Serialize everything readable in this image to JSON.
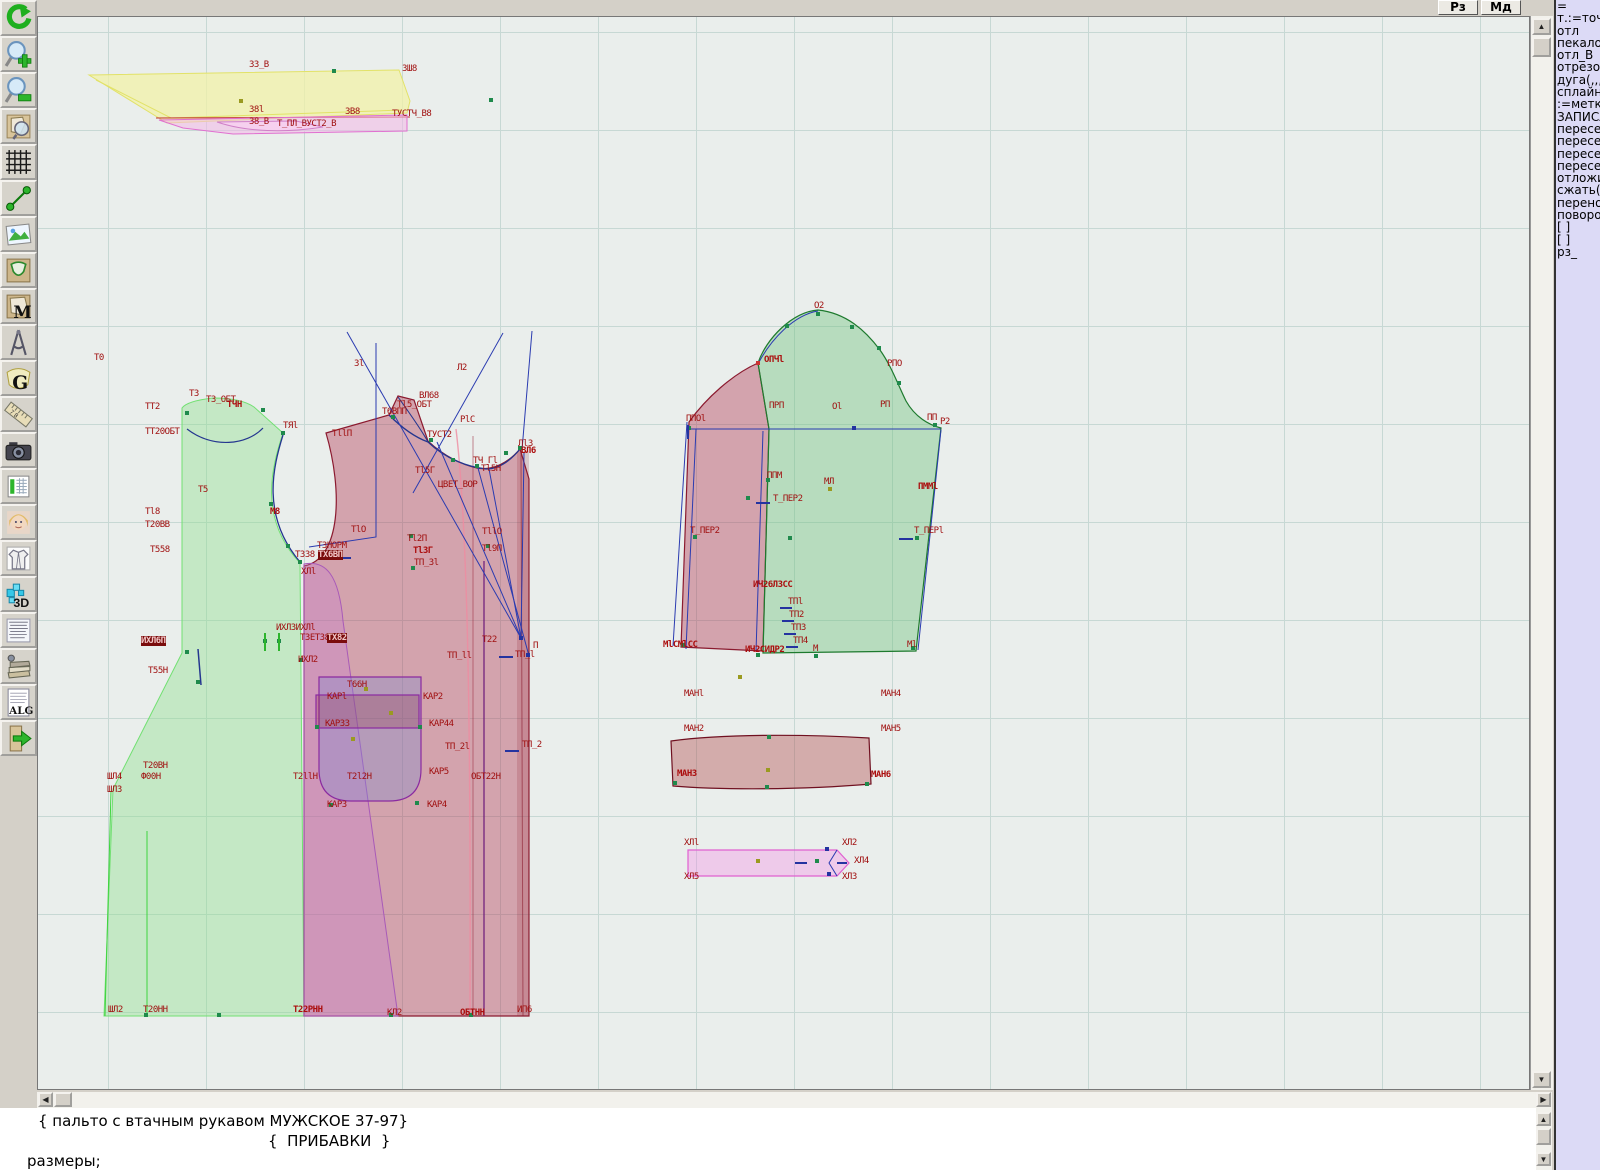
{
  "window": {
    "rz_button": "Рз",
    "md_button": "Мд"
  },
  "toolbar": {
    "items": [
      {
        "name": "undo",
        "glyph": ""
      },
      {
        "name": "zoom-in",
        "glyph": ""
      },
      {
        "name": "zoom-out",
        "glyph": ""
      },
      {
        "name": "preview",
        "glyph": ""
      },
      {
        "name": "grid",
        "glyph": ""
      },
      {
        "name": "line-tool",
        "glyph": ""
      },
      {
        "name": "image",
        "glyph": ""
      },
      {
        "name": "pattern",
        "glyph": ""
      },
      {
        "name": "pattern-m",
        "glyph": "M"
      },
      {
        "name": "compass",
        "glyph": ""
      },
      {
        "name": "g-tool",
        "glyph": "G"
      },
      {
        "name": "ruler",
        "glyph": "7 8"
      },
      {
        "name": "camera",
        "glyph": ""
      },
      {
        "name": "table",
        "glyph": ""
      },
      {
        "name": "portrait",
        "glyph": ""
      },
      {
        "name": "garment",
        "glyph": ""
      },
      {
        "name": "three-d",
        "glyph": "3D"
      },
      {
        "name": "text-list",
        "glyph": ""
      },
      {
        "name": "books",
        "glyph": ""
      },
      {
        "name": "alg",
        "glyph": "ALG"
      },
      {
        "name": "exit",
        "glyph": ""
      }
    ]
  },
  "right_panel": {
    "lines": [
      "=",
      "т.:=точка",
      "отл",
      "пекало",
      "отл_В",
      "отрезок",
      "дуга(,,,)",
      "сплайн_",
      ":=метка",
      "ЗАПИСА",
      "пересеч",
      "пересеч",
      "пересеч",
      "пересеч",
      "отложит",
      "сжать(()",
      "перенос",
      "поворот",
      "[ ]",
      "[ ]",
      "рз_"
    ]
  },
  "bottom_panel": {
    "lines": [
      "{ пальто с втачным рукавом МУЖСКОЕ 37-97}",
      "{  ПРИБАВКИ  }",
      "размеры;"
    ]
  },
  "colors": {
    "canvas_bg": "#eaeeec",
    "grid_line": "#c7d8d4",
    "label_red": "#a01010",
    "back_piece_green": "#8ee08e",
    "front_piece_maroon": "#b23350",
    "facing_violet": "#c77fd0",
    "sleeve_green": "#6fc47f",
    "pink_band": "#f688e8",
    "collar_yellow": "#f2f2a8",
    "construction_blue": "#2a3bb0",
    "panel_bg": "#dcdaf6"
  },
  "canvas": {
    "labels": [
      {
        "t": "З3_В",
        "x": 248,
        "y": 63
      },
      {
        "t": "ЗШ8",
        "x": 401,
        "y": 67
      },
      {
        "t": "З8l",
        "x": 248,
        "y": 108
      },
      {
        "t": "ЗВ8",
        "x": 344,
        "y": 110
      },
      {
        "t": "ТУСТЧ_В8",
        "x": 391,
        "y": 112
      },
      {
        "t": "З8_В",
        "x": 248,
        "y": 120
      },
      {
        "t": "Т_ПЛ_ВУСТ2_В",
        "x": 276,
        "y": 122
      },
      {
        "t": "Т0",
        "x": 93,
        "y": 356
      },
      {
        "t": "Т3",
        "x": 188,
        "y": 392
      },
      {
        "t": "Т3_ОБТ",
        "x": 205,
        "y": 398
      },
      {
        "t": "ТТ2",
        "x": 144,
        "y": 405
      },
      {
        "t": "ТЧН",
        "x": 226,
        "y": 403,
        "b": 1
      },
      {
        "t": "ТТ20ОБТ",
        "x": 144,
        "y": 430
      },
      {
        "t": "ТЯl",
        "x": 282,
        "y": 424
      },
      {
        "t": "Т5",
        "x": 197,
        "y": 488
      },
      {
        "t": "Тl8",
        "x": 144,
        "y": 510
      },
      {
        "t": "М8",
        "x": 269,
        "y": 510,
        "b": 1
      },
      {
        "t": "Т20ВВ",
        "x": 144,
        "y": 523
      },
      {
        "t": "Т558",
        "x": 149,
        "y": 548
      },
      {
        "t": "ТЗНОРМ",
        "x": 316,
        "y": 544
      },
      {
        "t": "Т338",
        "x": 294,
        "y": 553
      },
      {
        "t": "ТХ6ВП",
        "x": 317,
        "y": 553,
        "hl": 1
      },
      {
        "t": "ХЛl",
        "x": 300,
        "y": 570
      },
      {
        "t": "ИХЛЗИХЛl",
        "x": 275,
        "y": 626
      },
      {
        "t": "Т3ЕТ38",
        "x": 299,
        "y": 636
      },
      {
        "t": "ТХ82",
        "x": 326,
        "y": 636,
        "hl": 1
      },
      {
        "t": "ИХЛ6П",
        "x": 140,
        "y": 639,
        "hl": 1
      },
      {
        "t": "ИХЛ2",
        "x": 297,
        "y": 658
      },
      {
        "t": "Т55Н",
        "x": 147,
        "y": 669
      },
      {
        "t": "Т20ВН",
        "x": 142,
        "y": 764
      },
      {
        "t": "ШЛ4",
        "x": 106,
        "y": 775
      },
      {
        "t": "Ф00Н",
        "x": 140,
        "y": 775
      },
      {
        "t": "ШЛ3",
        "x": 106,
        "y": 788
      },
      {
        "t": "ШЛ2",
        "x": 107,
        "y": 1008
      },
      {
        "t": "Т20НН",
        "x": 142,
        "y": 1008
      },
      {
        "t": "Т22РНН",
        "x": 292,
        "y": 1008,
        "b": 1
      },
      {
        "t": "КЛ2",
        "x": 386,
        "y": 1011
      },
      {
        "t": "ОБТНН",
        "x": 459,
        "y": 1011,
        "b": 1
      },
      {
        "t": "ИП6",
        "x": 516,
        "y": 1008
      },
      {
        "t": "Зl",
        "x": 353,
        "y": 362
      },
      {
        "t": "Л2",
        "x": 456,
        "y": 366
      },
      {
        "t": "ВЛ68",
        "x": 418,
        "y": 394
      },
      {
        "t": "Тl5_ОБТ",
        "x": 396,
        "y": 403
      },
      {
        "t": "Т6ВПП",
        "x": 381,
        "y": 410
      },
      {
        "t": "РlС",
        "x": 459,
        "y": 418
      },
      {
        "t": "ТllП",
        "x": 331,
        "y": 432
      },
      {
        "t": "ТУСТ2",
        "x": 426,
        "y": 433
      },
      {
        "t": "Лl3",
        "x": 517,
        "y": 442
      },
      {
        "t": "ВЛ6",
        "x": 520,
        "y": 449,
        "b": 1
      },
      {
        "t": "ТЧ_Гl",
        "x": 472,
        "y": 459
      },
      {
        "t": "Тl5Н",
        "x": 480,
        "y": 467
      },
      {
        "t": "Тl5Г",
        "x": 414,
        "y": 469
      },
      {
        "t": "ЦВЕТ_ВОР",
        "x": 437,
        "y": 483
      },
      {
        "t": "ТlО",
        "x": 350,
        "y": 528
      },
      {
        "t": "Тl2П",
        "x": 406,
        "y": 537
      },
      {
        "t": "ТllО",
        "x": 481,
        "y": 530
      },
      {
        "t": "ТlЗГ",
        "x": 412,
        "y": 549,
        "b": 1
      },
      {
        "t": "Тl9П",
        "x": 481,
        "y": 547
      },
      {
        "t": "ТП_Зl",
        "x": 413,
        "y": 561
      },
      {
        "t": "Т22",
        "x": 481,
        "y": 638
      },
      {
        "t": "ТП_ll",
        "x": 446,
        "y": 654
      },
      {
        "t": "ТП_l",
        "x": 514,
        "y": 653
      },
      {
        "t": "П",
        "x": 532,
        "y": 644
      },
      {
        "t": "Т66Н",
        "x": 346,
        "y": 683
      },
      {
        "t": "КАРl",
        "x": 326,
        "y": 695
      },
      {
        "t": "КАР2",
        "x": 422,
        "y": 695
      },
      {
        "t": "КАР33",
        "x": 324,
        "y": 722
      },
      {
        "t": "КАР44",
        "x": 428,
        "y": 722
      },
      {
        "t": "ТП_2l",
        "x": 444,
        "y": 745
      },
      {
        "t": "ТП_2",
        "x": 521,
        "y": 743
      },
      {
        "t": "Т2llН",
        "x": 292,
        "y": 775
      },
      {
        "t": "Т2l2Н",
        "x": 346,
        "y": 775
      },
      {
        "t": "КАР5",
        "x": 428,
        "y": 770
      },
      {
        "t": "ОБТ22Н",
        "x": 470,
        "y": 775
      },
      {
        "t": "КАР3",
        "x": 326,
        "y": 803
      },
      {
        "t": "КАР4",
        "x": 426,
        "y": 803
      },
      {
        "t": "О2",
        "x": 813,
        "y": 304
      },
      {
        "t": "ОПЧl",
        "x": 763,
        "y": 358,
        "b": 1
      },
      {
        "t": "РПО",
        "x": 886,
        "y": 362
      },
      {
        "t": "ПРП",
        "x": 768,
        "y": 404
      },
      {
        "t": "Оl",
        "x": 831,
        "y": 405
      },
      {
        "t": "РП",
        "x": 879,
        "y": 403
      },
      {
        "t": "ПП",
        "x": 926,
        "y": 416
      },
      {
        "t": "Р2",
        "x": 939,
        "y": 420
      },
      {
        "t": "ППОl",
        "x": 685,
        "y": 417
      },
      {
        "t": "ППМ",
        "x": 766,
        "y": 474
      },
      {
        "t": "МЛ",
        "x": 823,
        "y": 480
      },
      {
        "t": "ПММl",
        "x": 917,
        "y": 485,
        "b": 1
      },
      {
        "t": "Т_ПЕР2",
        "x": 772,
        "y": 497
      },
      {
        "t": "Т_ПЕР2",
        "x": 689,
        "y": 529
      },
      {
        "t": "Т_ПЕРl",
        "x": 913,
        "y": 529
      },
      {
        "t": "ИЧ26ЛЗСС",
        "x": 752,
        "y": 583,
        "b": 1
      },
      {
        "t": "ТПl",
        "x": 787,
        "y": 600
      },
      {
        "t": "ТП2",
        "x": 788,
        "y": 613
      },
      {
        "t": "ТП3",
        "x": 790,
        "y": 626
      },
      {
        "t": "ТП4",
        "x": 792,
        "y": 639
      },
      {
        "t": "МlСМlСС",
        "x": 662,
        "y": 643,
        "b": 1
      },
      {
        "t": "ИЧ2СИДР2",
        "x": 744,
        "y": 648,
        "b": 1
      },
      {
        "t": "М",
        "x": 812,
        "y": 647
      },
      {
        "t": "Мl",
        "x": 906,
        "y": 643
      },
      {
        "t": "МАНl",
        "x": 683,
        "y": 692
      },
      {
        "t": "МАН4",
        "x": 880,
        "y": 692
      },
      {
        "t": "МАН2",
        "x": 683,
        "y": 727
      },
      {
        "t": "МАН5",
        "x": 880,
        "y": 727
      },
      {
        "t": "МАН3",
        "x": 676,
        "y": 772,
        "b": 1
      },
      {
        "t": "МАН6",
        "x": 870,
        "y": 773,
        "b": 1
      },
      {
        "t": "ХЛl",
        "x": 683,
        "y": 841
      },
      {
        "t": "ХЛ2",
        "x": 841,
        "y": 841
      },
      {
        "t": "ХЛ4",
        "x": 853,
        "y": 859
      },
      {
        "t": "ХЛ5",
        "x": 683,
        "y": 875
      },
      {
        "t": "ХЛ3",
        "x": 841,
        "y": 875
      }
    ],
    "points": [
      [
        333,
        70,
        "g"
      ],
      [
        240,
        100,
        "o"
      ],
      [
        490,
        99,
        "g"
      ],
      [
        186,
        412,
        "g"
      ],
      [
        262,
        409,
        "g"
      ],
      [
        282,
        432,
        "g"
      ],
      [
        270,
        503,
        "g"
      ],
      [
        287,
        545,
        "g"
      ],
      [
        299,
        561,
        "g"
      ],
      [
        186,
        651,
        "g"
      ],
      [
        197,
        681,
        "g"
      ],
      [
        264,
        640,
        "g"
      ],
      [
        278,
        640,
        "g"
      ],
      [
        218,
        1014,
        "g"
      ],
      [
        145,
        1014,
        "g"
      ],
      [
        392,
        416,
        "g"
      ],
      [
        430,
        439,
        "g"
      ],
      [
        452,
        459,
        "g"
      ],
      [
        476,
        465,
        "g"
      ],
      [
        505,
        452,
        "g"
      ],
      [
        519,
        447,
        "g"
      ],
      [
        410,
        535,
        "g"
      ],
      [
        487,
        545,
        "g"
      ],
      [
        412,
        567,
        "g"
      ],
      [
        520,
        637,
        "n"
      ],
      [
        527,
        654,
        "n"
      ],
      [
        300,
        659,
        "g"
      ],
      [
        390,
        1014,
        "g"
      ],
      [
        470,
        1014,
        "g"
      ],
      [
        365,
        688,
        "o"
      ],
      [
        390,
        712,
        "o"
      ],
      [
        352,
        738,
        "o"
      ],
      [
        330,
        804,
        "g"
      ],
      [
        416,
        802,
        "g"
      ],
      [
        316,
        726,
        "g"
      ],
      [
        419,
        726,
        "g"
      ],
      [
        817,
        313,
        "g"
      ],
      [
        786,
        325,
        "g"
      ],
      [
        851,
        326,
        "g"
      ],
      [
        878,
        347,
        "g"
      ],
      [
        757,
        362,
        "r"
      ],
      [
        898,
        382,
        "g"
      ],
      [
        688,
        427,
        "g"
      ],
      [
        853,
        427,
        "n"
      ],
      [
        934,
        424,
        "g"
      ],
      [
        767,
        479,
        "g"
      ],
      [
        829,
        488,
        "o"
      ],
      [
        747,
        497,
        "g"
      ],
      [
        789,
        537,
        "g"
      ],
      [
        916,
        537,
        "g"
      ],
      [
        694,
        536,
        "g"
      ],
      [
        912,
        647,
        "g"
      ],
      [
        815,
        655,
        "g"
      ],
      [
        757,
        654,
        "g"
      ],
      [
        682,
        644,
        "g"
      ],
      [
        739,
        676,
        "o"
      ],
      [
        768,
        736,
        "g"
      ],
      [
        767,
        769,
        "o"
      ],
      [
        766,
        786,
        "g"
      ],
      [
        674,
        782,
        "g"
      ],
      [
        866,
        783,
        "g"
      ],
      [
        757,
        860,
        "o"
      ],
      [
        816,
        860,
        "g"
      ],
      [
        826,
        848,
        "n"
      ],
      [
        828,
        873,
        "n"
      ]
    ],
    "ticks": [
      [
        755,
        501,
        14,
        2
      ],
      [
        898,
        537,
        14,
        2
      ],
      [
        686,
        424,
        2,
        14
      ],
      [
        779,
        606,
        12,
        2
      ],
      [
        781,
        619,
        12,
        2
      ],
      [
        783,
        632,
        12,
        2
      ],
      [
        785,
        645,
        12,
        2
      ],
      [
        498,
        655,
        14,
        2
      ],
      [
        504,
        749,
        14,
        2
      ],
      [
        794,
        861,
        12,
        2
      ],
      [
        836,
        861,
        10,
        2
      ],
      [
        340,
        556,
        10,
        2
      ],
      [
        263,
        632,
        2,
        18,
        "g"
      ],
      [
        277,
        632,
        2,
        18,
        "g"
      ]
    ]
  }
}
